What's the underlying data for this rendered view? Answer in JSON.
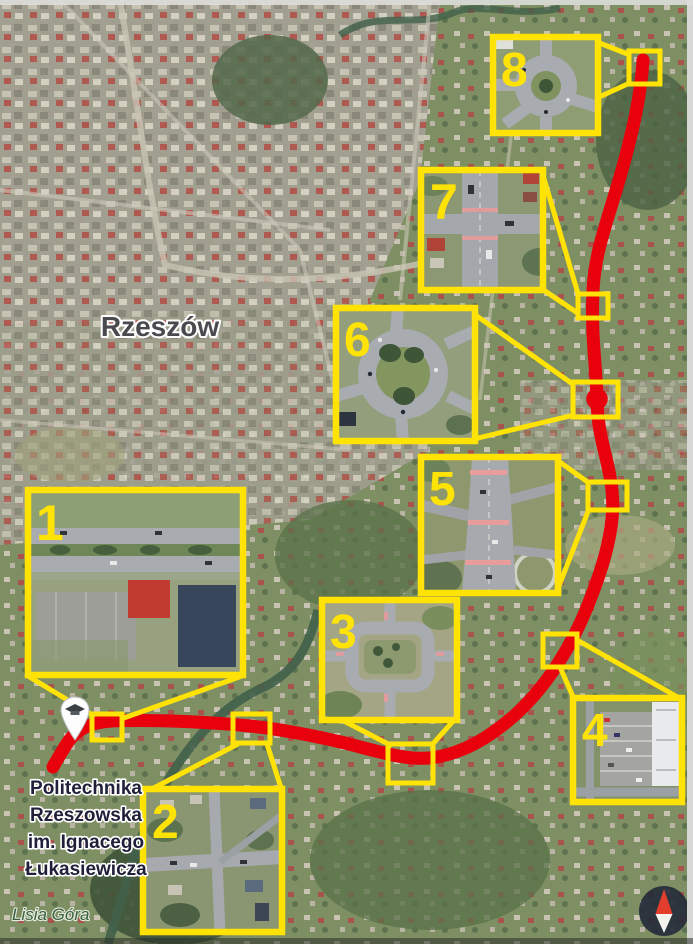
{
  "map": {
    "type": "satellite-route-map",
    "city_label": "Rzeszów",
    "hill_label": "Lisia Góra",
    "university_label": {
      "line1": "Politechnika",
      "line2": "Rzeszowska",
      "line3": "im. Ignacego",
      "line4": "Łukasiewicza"
    },
    "route_color": "#e8000d",
    "callout_color": "#ffe206",
    "callouts": [
      {
        "number": "1",
        "scene": "divided-road-segment"
      },
      {
        "number": "2",
        "scene": "crossroads"
      },
      {
        "number": "3",
        "scene": "square-roundabout"
      },
      {
        "number": "4",
        "scene": "parking-lot-junction"
      },
      {
        "number": "5",
        "scene": "multi-lane-intersection"
      },
      {
        "number": "6",
        "scene": "large-roundabout"
      },
      {
        "number": "7",
        "scene": "signalized-crossroads"
      },
      {
        "number": "8",
        "scene": "roundabout"
      }
    ],
    "markers": {
      "university_pin": "graduation-cap-pin",
      "route_ring": "ring-marker-on-route",
      "compass": "north-compass"
    }
  }
}
